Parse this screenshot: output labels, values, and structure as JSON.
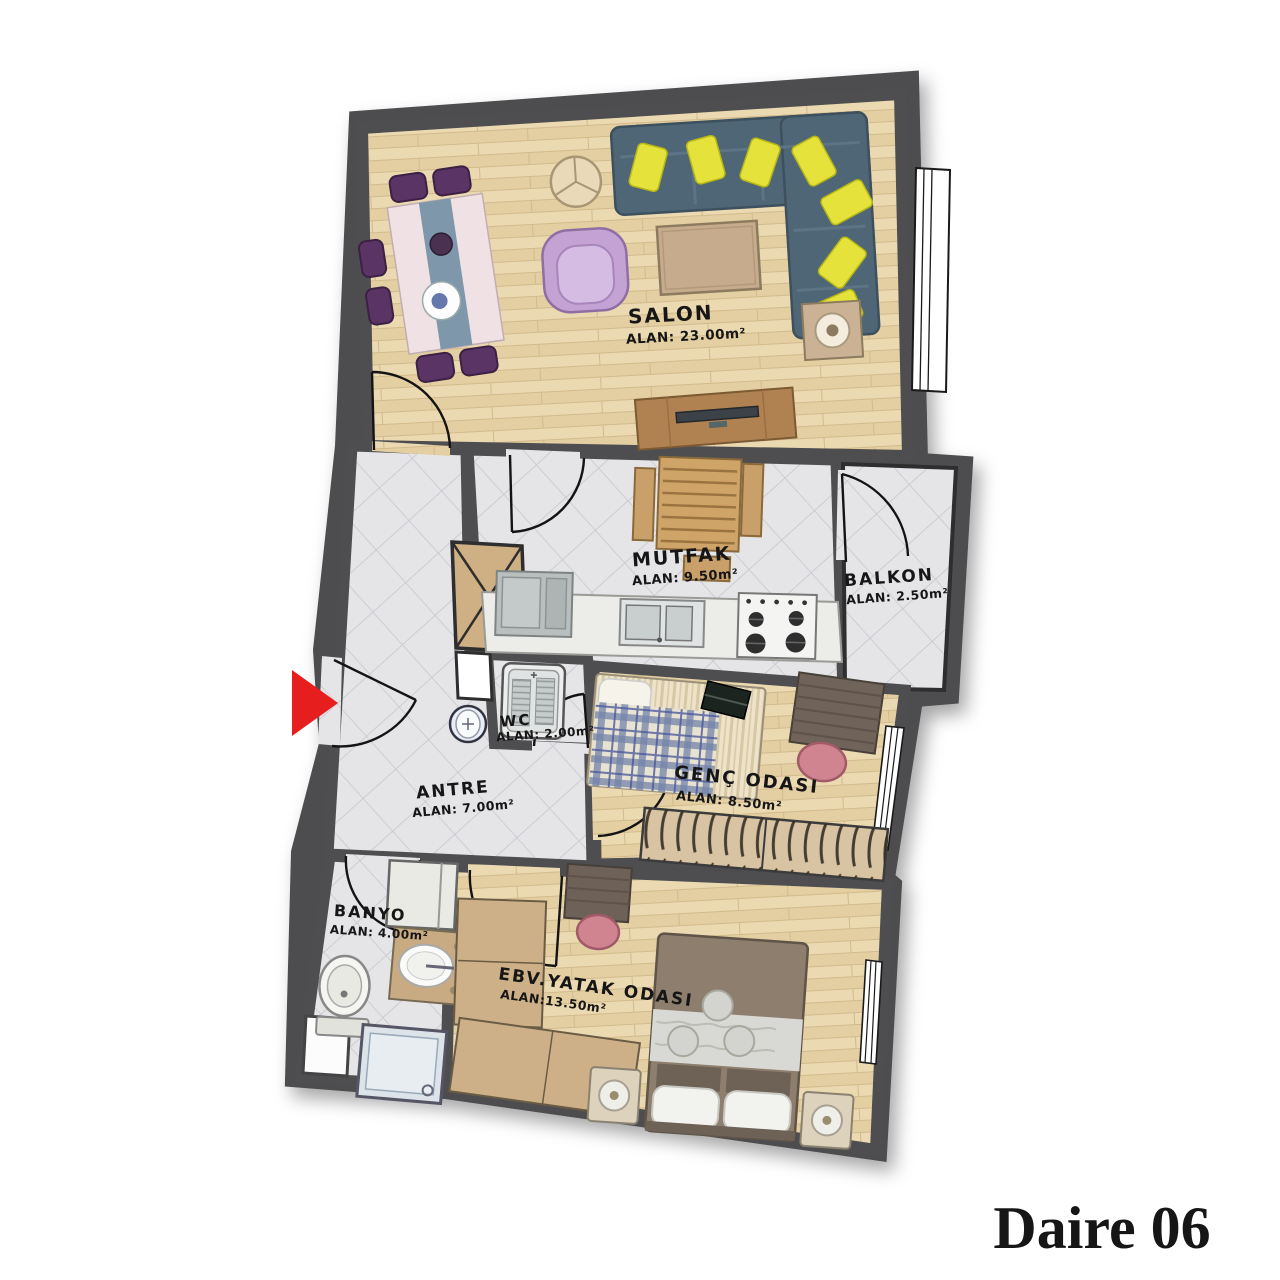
{
  "title": {
    "text": "Daire 06",
    "color": "#2b333d"
  },
  "plan": {
    "rooms": [
      {
        "id": "salon",
        "name": "SALON",
        "area": "ALAN: 23.00m²"
      },
      {
        "id": "mutfak",
        "name": "MUTFAK",
        "area": "ALAN: 9.50m²"
      },
      {
        "id": "balkon",
        "name": "BALKON",
        "area": "ALAN: 2.50m²"
      },
      {
        "id": "wc",
        "name": "WC",
        "area": "ALAN: 2.00m²"
      },
      {
        "id": "antre",
        "name": "ANTRE",
        "area": "ALAN: 7.00m²"
      },
      {
        "id": "genc_odasi",
        "name": "GENÇ ODASI",
        "area": "ALAN: 8.50m²"
      },
      {
        "id": "banyo",
        "name": "BANYO",
        "area": "ALAN: 4.00m²"
      },
      {
        "id": "ebv_yatak",
        "name": "EBV.YATAK ODASI",
        "area": "ALAN:13.50m²"
      }
    ],
    "entrance_marker": {
      "icon": "entrance-arrow-icon",
      "direction": "right",
      "color": "#e61e1e"
    },
    "colors": {
      "wall": "#4e4e50",
      "wood_floor": "#ebd9b1",
      "tile_floor": "#e5e5e8",
      "sofa": "#4f6677",
      "sofa_pillow": "#e5e33b",
      "armchair": "#c4a2d3",
      "dining_chair": "#5a3465",
      "desk_chair": "#cf8490",
      "wardrobe": "#cdb088",
      "bed_cover": "#8e7e6d",
      "title_text": "#2b333d",
      "entrance_arrow": "#e61e1e"
    },
    "furniture": {
      "salon": [
        "dining-table",
        "dining-chairs",
        "round-side-table",
        "corner-sofa",
        "sofa-pillows",
        "armchair",
        "coffee-table",
        "speaker-table",
        "tv-unit"
      ],
      "mutfak": [
        "kitchen-table",
        "benches",
        "fridge",
        "counter",
        "sink",
        "stove"
      ],
      "wc": [
        "squat-toilet",
        "hand-sink"
      ],
      "genc_odasi": [
        "single-bed",
        "laptop",
        "desk",
        "desk-chair",
        "wardrobe"
      ],
      "banyo": [
        "washing-machine",
        "vanity-sink",
        "toilet",
        "shower"
      ],
      "ebv_yatak": [
        "double-bed",
        "nightstands",
        "lamps",
        "desk",
        "desk-chair",
        "corner-wardrobe"
      ]
    }
  }
}
